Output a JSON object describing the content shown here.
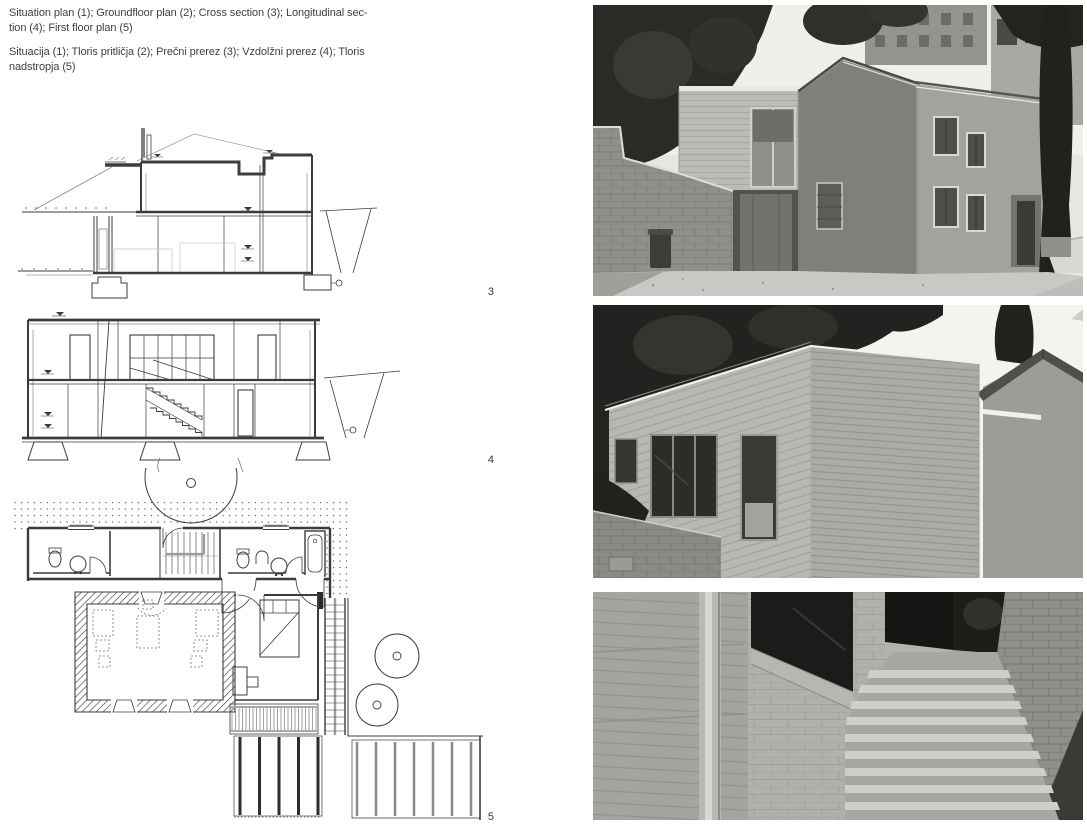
{
  "caption": {
    "en_lines": [
      "Situation plan (1); Groundfloor plan (2); Cross section (3); Longitudinal sec-",
      "tion (4); First floor plan (5)"
    ],
    "sl_lines": [
      "Situacija (1); Tloris pritličja (2); Prečni prerez (3); Vzdolžni prerez (4); Tloris",
      "nadstropja (5)"
    ]
  },
  "figures": {
    "cross_section": {
      "number": "3"
    },
    "longitudinal_section": {
      "number": "4"
    },
    "first_floor_plan": {
      "number": "5"
    }
  },
  "colors": {
    "paper": "#ffffff",
    "drawing_line": "#3c3c3c",
    "caption_text": "#3f3f3f"
  }
}
